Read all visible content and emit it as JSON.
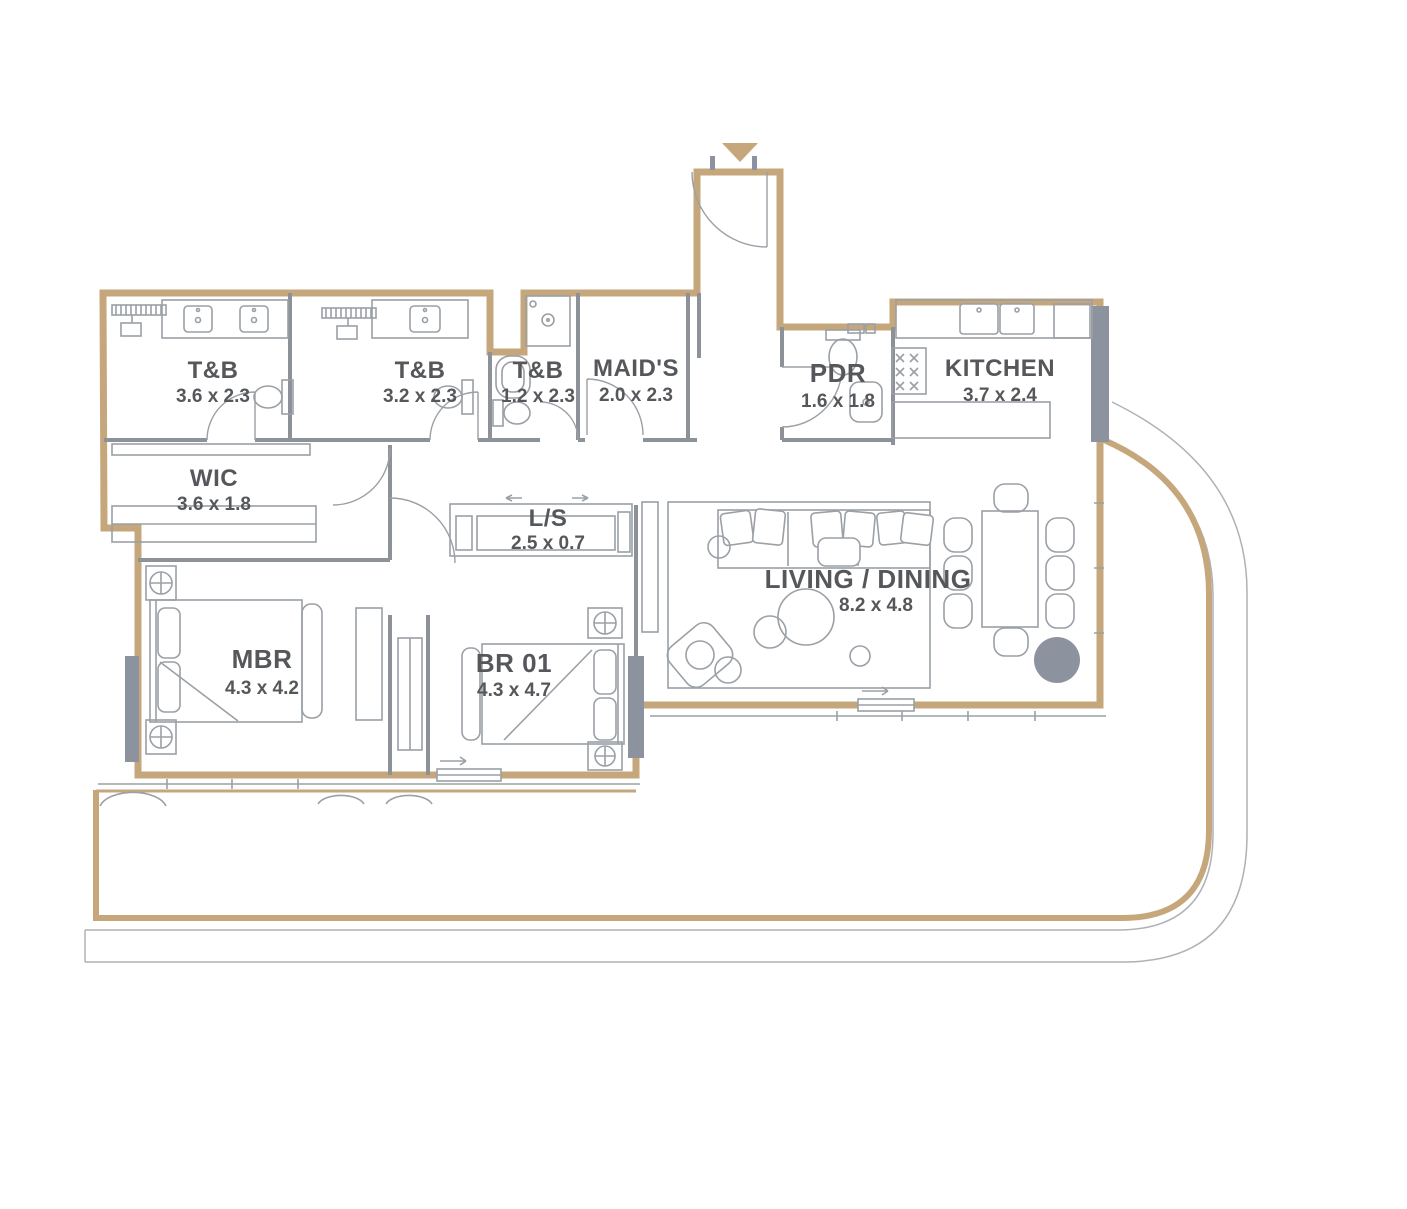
{
  "plan": {
    "type": "residential-floor-plan",
    "entry": {
      "marker_icon": "down-triangle"
    }
  },
  "colors": {
    "wall_tan": "#C6A77C",
    "interior_wall_gray": "#8D9298",
    "fixture_line_gray": "#9AA0A6",
    "solid_fill_gray": "#8C939E",
    "label_text_gray": "#55575A",
    "facade_line_gray": "#AEB2B5",
    "background": "#FFFFFF"
  },
  "rooms": [
    {
      "name": "T&B",
      "dims": "3.6 x 2.3"
    },
    {
      "name": "T&B",
      "dims": "3.2 x 2.3"
    },
    {
      "name": "T&B",
      "dims": "1.2 x 2.3"
    },
    {
      "name": "MAID'S",
      "dims": "2.0 x 2.3"
    },
    {
      "name": "PDR",
      "dims": "1.6 x 1.8"
    },
    {
      "name": "KITCHEN",
      "dims": "3.7 x 2.4"
    },
    {
      "name": "WIC",
      "dims": "3.6 x 1.8"
    },
    {
      "name": "L/S",
      "dims": "2.5 x 0.7"
    },
    {
      "name": "MBR",
      "dims": "4.3 x 4.2"
    },
    {
      "name": "BR 01",
      "dims": "4.3 x 4.7"
    },
    {
      "name": "LIVING / DINING",
      "dims": "8.2 x 4.8"
    }
  ]
}
